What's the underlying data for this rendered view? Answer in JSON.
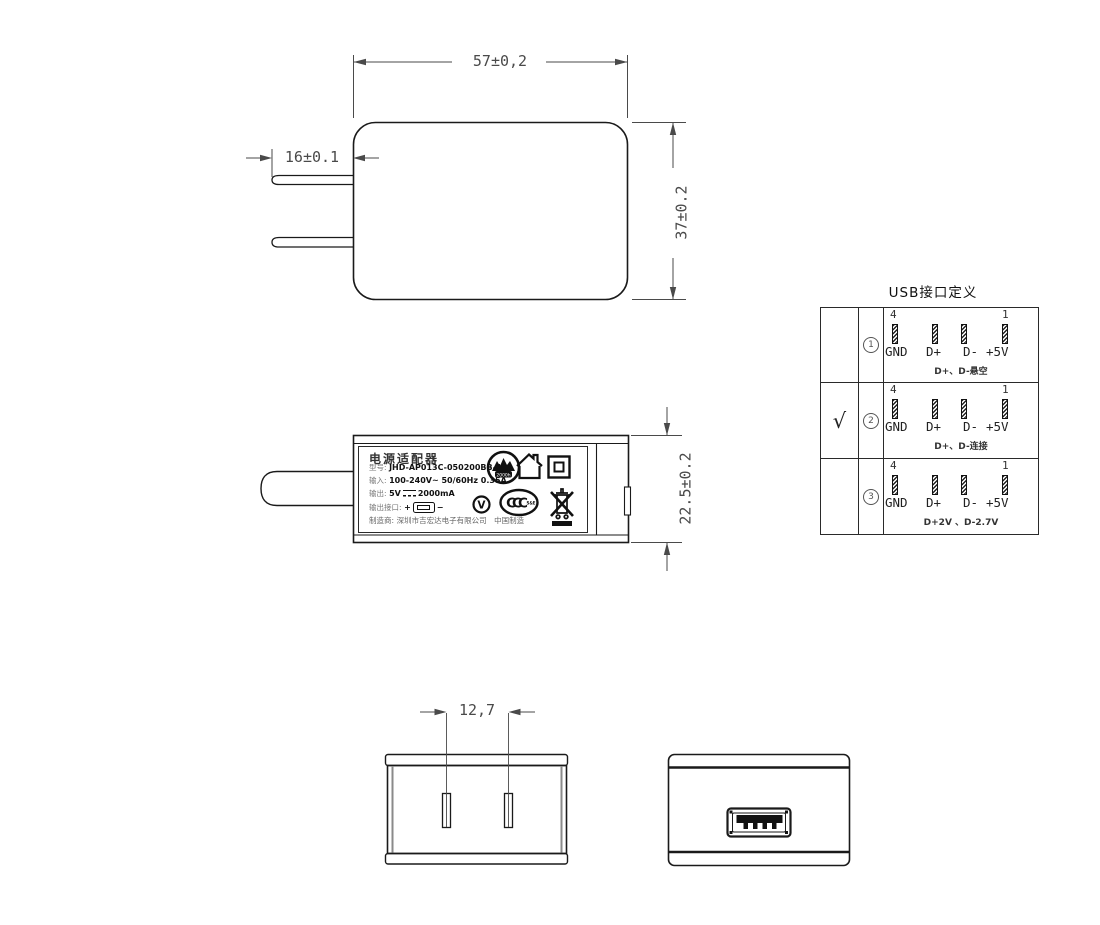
{
  "dimensions": {
    "top_width": "57±0,2",
    "prong_length": "16±0.1",
    "body_height": "37±0.2",
    "side_thickness": "22.5±0.2",
    "prong_spacing": "12,7"
  },
  "label": {
    "title": "电源适配器",
    "model_label": "型号:",
    "model_value": "JHD-AP013C-050200BB-A",
    "input_label": "输入:",
    "input_value": "100-240V~  50/60Hz  0.35A",
    "output_label": "输出:",
    "output_value_pre": "5V",
    "output_value_post": "2000mA",
    "port_label": "输出接口:",
    "port_plus": "+",
    "port_minus": "−",
    "maker_label": "制造商:",
    "maker_value": "深圳市吉宏达电子有限公司",
    "origin": "中国制造",
    "logo_hours": "2000h",
    "efficiency_mark": "V",
    "ccc_text": "CCC",
    "ccc_sub": "S&E"
  },
  "usb_table": {
    "title": "USB接口定义",
    "pin_top_left": "4",
    "pin_top_right": "1",
    "pin_labels": [
      "GND",
      "D+",
      "D-",
      "+5V"
    ],
    "rows": [
      {
        "selected": "",
        "index": "1",
        "note": "D+、D-悬空"
      },
      {
        "selected": "√",
        "index": "2",
        "note": "D+、D-连接"
      },
      {
        "selected": "",
        "index": "3",
        "note": "D+2V 、D-2.7V"
      }
    ]
  }
}
